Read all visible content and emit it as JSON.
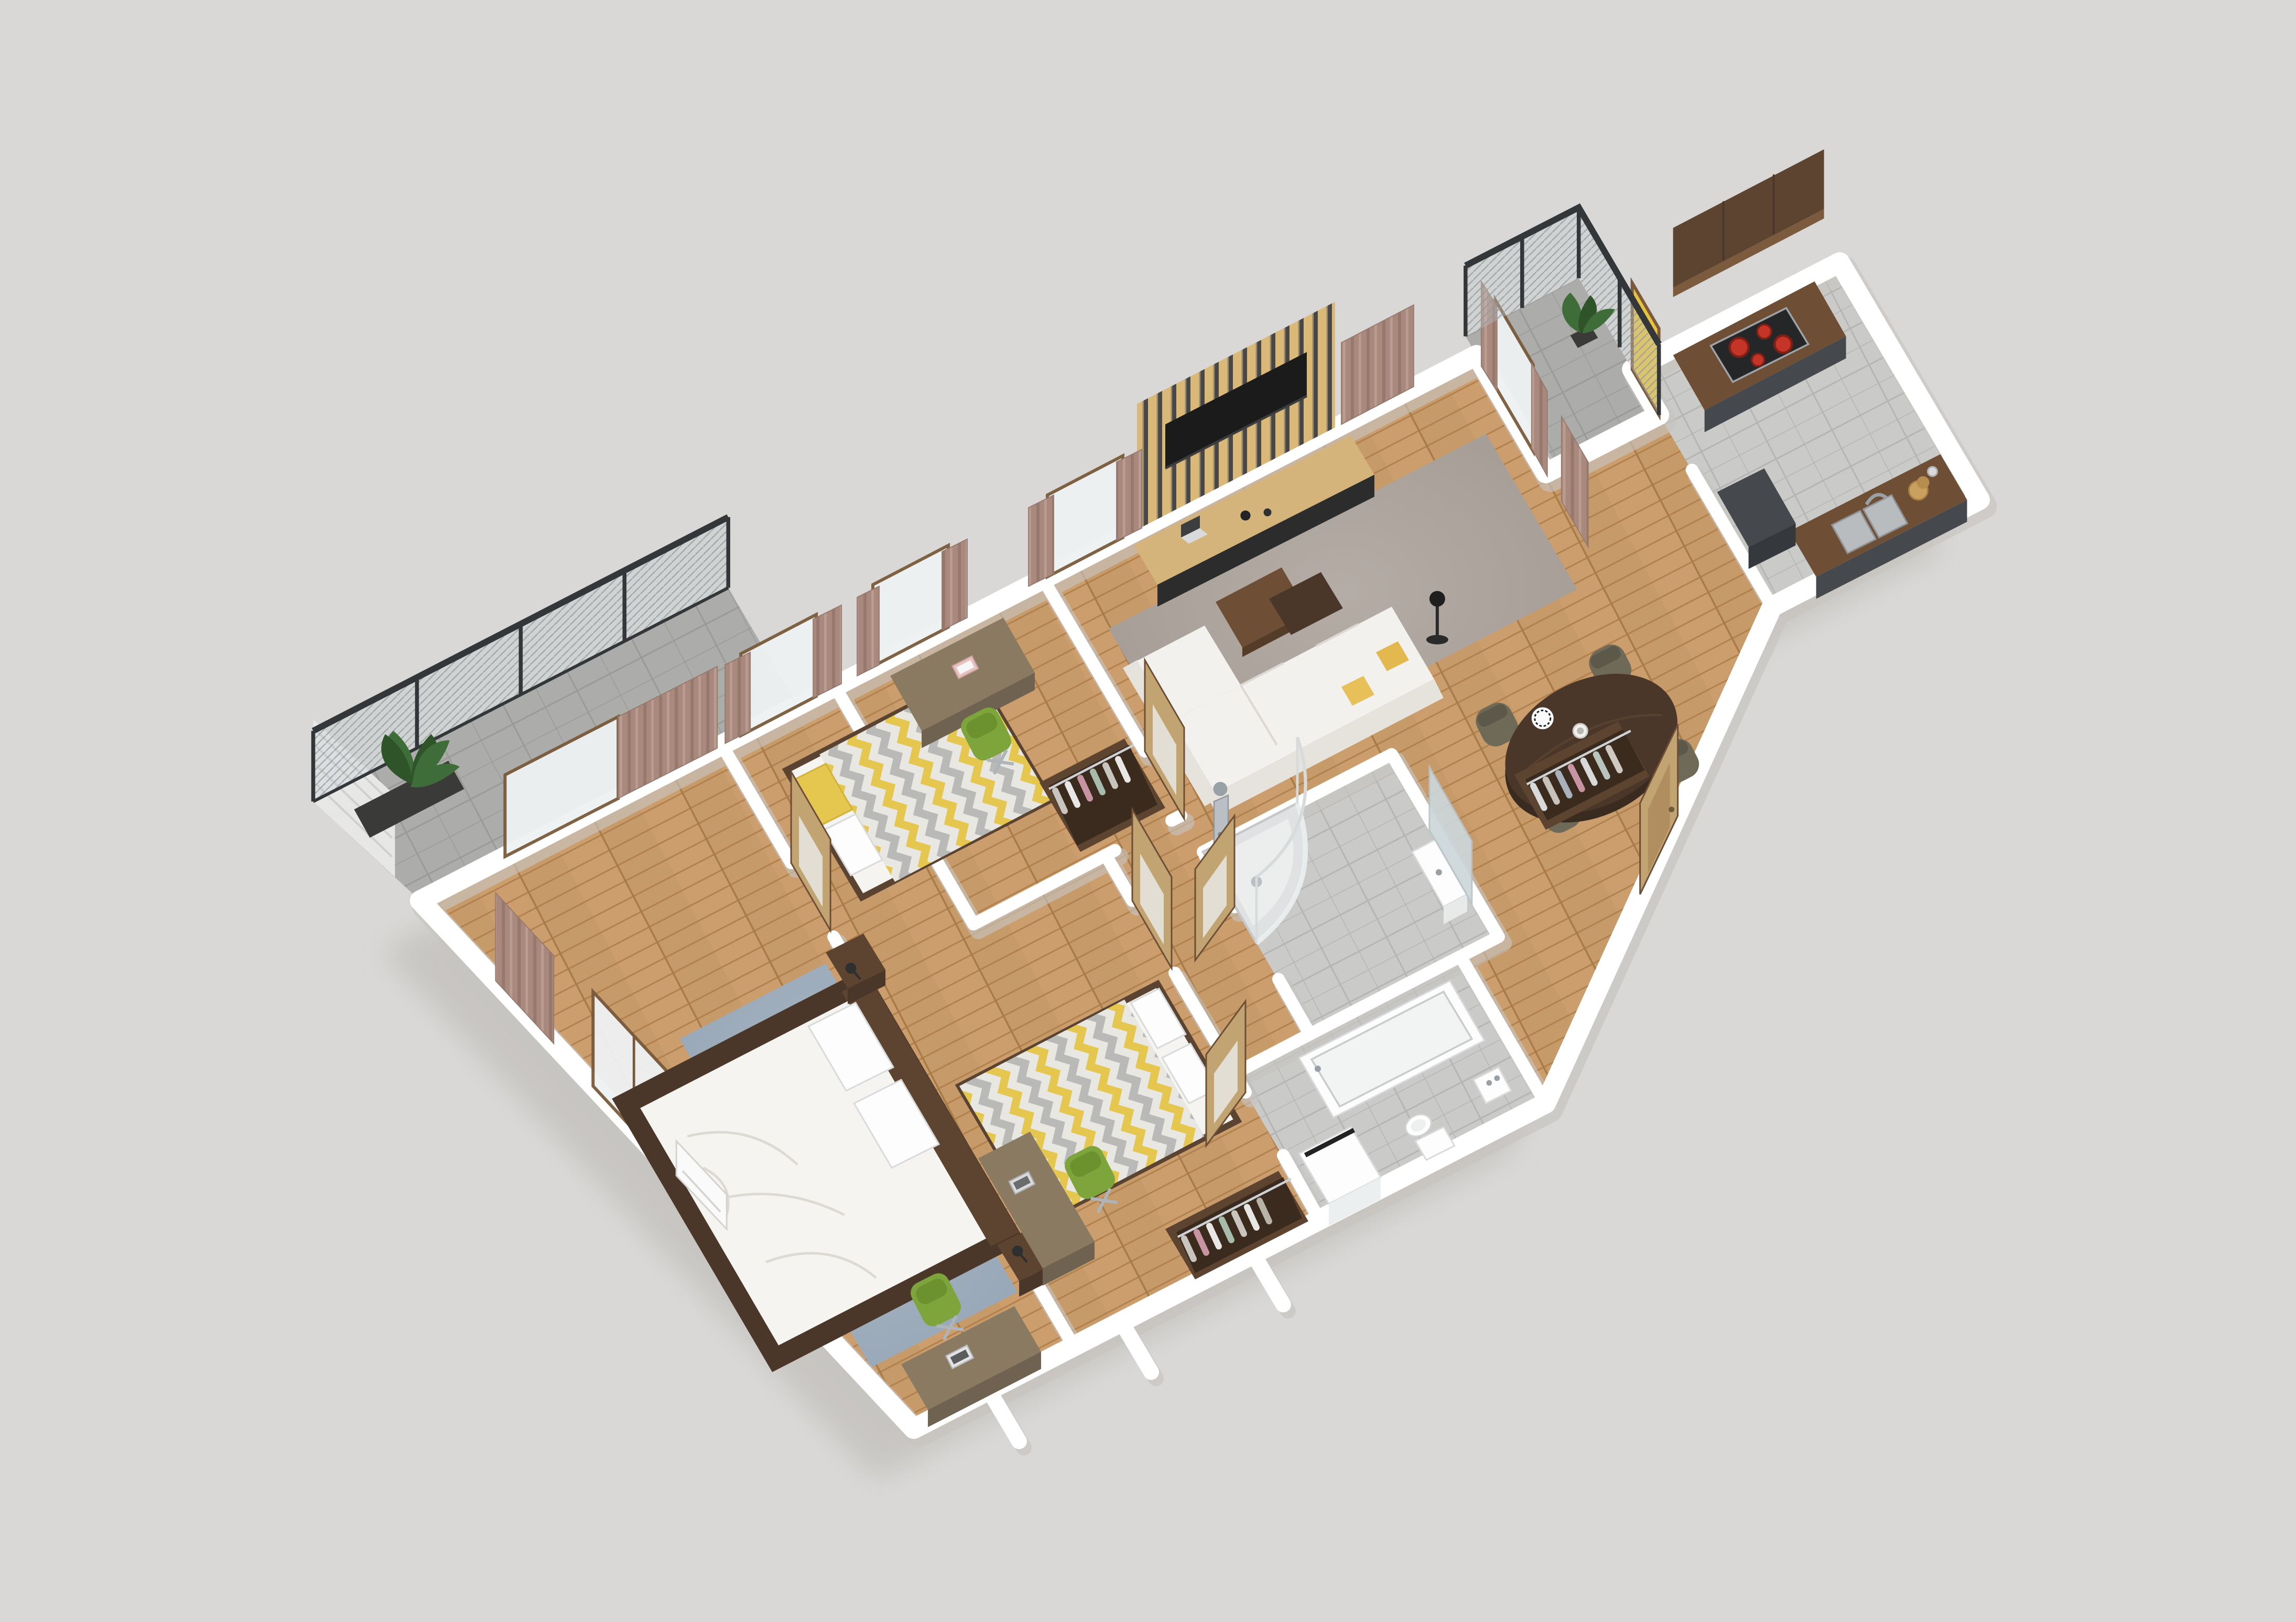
{
  "scene": {
    "description": "3D isometric top-down rendering of a furnished apartment floor plan on a plain light gray background",
    "view": "isometric-render",
    "background": "#d9d8d6"
  },
  "palette": {
    "bg": "#d9d8d6",
    "wall": "#ffffff",
    "wall-shadow": "#c7c4c0",
    "floor-wood": "#c79a6a",
    "floor-wood-line": "#b2814c",
    "tile": "#cacac8",
    "tile-line": "#b5b5b3",
    "balcony-tile": "#acacaa",
    "rug-living": "#a9a09a",
    "rug-master": "#9fadbd",
    "walnut": "#5d4430",
    "walnut-dark": "#4a372a",
    "walnut-mid": "#6e4f36",
    "oak-slat": "#d9b878",
    "door-oak": "#c2a473",
    "cabinet-gray": "#45484c",
    "sofa-cream": "#f3f1ed",
    "sofa-shade": "#e6e2dc",
    "bedding": "#f5f4f1",
    "chevron-gray": "#b9b9b7",
    "chevron-yellow": "#e5c64f",
    "green-chair": "#7ea53c",
    "olive-chair": "#6f6a58",
    "curtain": "#a9897d",
    "curtain-dark": "#96786d",
    "railing": "#33373a",
    "mesh": "#aab0b3",
    "plant": "#3f6d39",
    "plant-dark": "#2f5429",
    "burner-red": "#c43427",
    "chrome": "#c7cdd2",
    "glass": "#eef2f3",
    "yellow-accent": "#e8c23f",
    "laptop-pink": "#e8c3c0",
    "window-frame": "#7a5a3c",
    "clothes-pink": "#c994a2",
    "clothes-sage": "#a8bcab",
    "clothes-gray": "#c9c5be",
    "shadow": "#b9b6b2",
    "tv-black": "#1b1b1b"
  },
  "apartment": {
    "rooms": [
      {
        "id": "master-bedroom",
        "furniture": [
          "double-bed",
          "white-duvet",
          "pillows",
          "walnut-bed-frame",
          "nightstand-left",
          "nightstand-right",
          "wall-lamp-left",
          "wall-lamp-right",
          "blue-gray-rug",
          "desk",
          "green-office-chair",
          "laptop",
          "window-to-balcony",
          "glazed-balcony-door",
          "curtains",
          "air-conditioner"
        ]
      },
      {
        "id": "bedroom-2",
        "furniture": [
          "bed-chevron-duvet",
          "white-pillows",
          "desk",
          "green-office-chair",
          "laptop",
          "open-wardrobe-with-clothes",
          "window",
          "curtains",
          "glazed-door"
        ]
      },
      {
        "id": "bedroom-3",
        "furniture": [
          "bed-chevron-duvet",
          "yellow-pillow",
          "desk",
          "green-office-chair",
          "pink-laptop",
          "open-wardrobe-with-clothes",
          "window",
          "curtains",
          "glazed-door"
        ]
      },
      {
        "id": "living-room",
        "furniture": [
          "wood-slat-tv-wall",
          "flat-tv",
          "media-console",
          "laptop-on-console",
          "vases",
          "l-shaped-white-sofa",
          "yellow-cushions",
          "nested-coffee-tables",
          "black-floor-lamp",
          "gray-rug",
          "windows",
          "curtains",
          "balcony-door"
        ]
      },
      {
        "id": "dining-area",
        "furniture": [
          "oval-walnut-table",
          "olive-dining-chair-1",
          "olive-dining-chair-2",
          "olive-dining-chair-3",
          "olive-dining-chair-4",
          "patterned-plates",
          "utensil-jar",
          "mug"
        ]
      },
      {
        "id": "kitchen",
        "furniture": [
          "walnut-upper-cabinets",
          "gray-base-cabinets",
          "cooktop-four-burners",
          "walnut-counter",
          "double-sink",
          "faucet",
          "cutting-boards",
          "tall-dark-unit",
          "yellow-balcony-door",
          "gray-tile-floor"
        ]
      },
      {
        "id": "shower-bathroom",
        "furniture": [
          "corner-shower",
          "curved-glass-enclosure",
          "chrome-shower-column",
          "washbasin",
          "mirror",
          "glazed-door",
          "gray-tile-floor"
        ]
      },
      {
        "id": "bathtub-bathroom",
        "furniture": [
          "bathtub",
          "washing-machine",
          "toilet",
          "small-washbasin",
          "glazed-door",
          "gray-tile-floor"
        ]
      },
      {
        "id": "hallway",
        "furniture": [
          "open-wardrobe-with-clothes",
          "shoe-bench",
          "entry-door",
          "wood-floor"
        ]
      }
    ],
    "balconies": [
      {
        "id": "balcony-left",
        "features": [
          "dark-metal-railing",
          "mesh-panels",
          "privacy-blind",
          "planter-box",
          "plant",
          "tile-floor"
        ]
      },
      {
        "id": "balcony-top-right",
        "features": [
          "dark-metal-railing",
          "mesh-panels",
          "potted-plant",
          "tile-floor"
        ]
      }
    ]
  }
}
